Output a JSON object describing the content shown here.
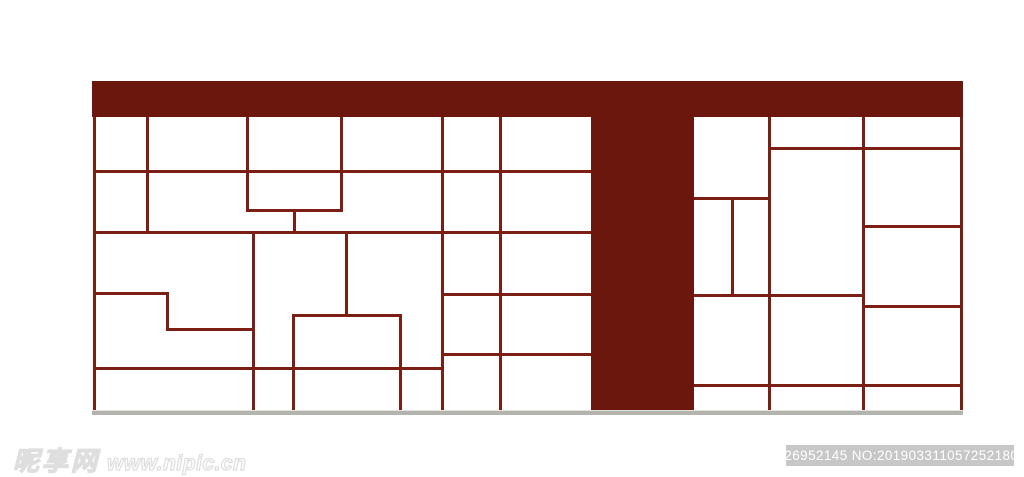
{
  "page": {
    "background": "#ffffff"
  },
  "artwork": {
    "description": "maroon T-shaped lattice partition screen drawing",
    "bar_color": "#6b170e",
    "line_color": "#7b1e13",
    "ground_color": "#b4b4af",
    "ground_highlight": "#e3e3dd",
    "line_thickness": 3,
    "beams": [
      {
        "name": "top-beam",
        "x": 92,
        "y": 81,
        "w": 871,
        "h": 36
      },
      {
        "name": "center-post",
        "x": 591,
        "y": 117,
        "w": 103,
        "h": 294
      }
    ],
    "lines": [
      {
        "x": 93,
        "y": 117,
        "len": 294,
        "dir": "v"
      },
      {
        "x": 146,
        "y": 117,
        "len": 115,
        "dir": "v"
      },
      {
        "x": 246,
        "y": 117,
        "len": 95,
        "dir": "v"
      },
      {
        "x": 340,
        "y": 117,
        "len": 95,
        "dir": "v"
      },
      {
        "x": 293,
        "y": 209,
        "len": 24,
        "dir": "v"
      },
      {
        "x": 441,
        "y": 117,
        "len": 294,
        "dir": "v"
      },
      {
        "x": 499,
        "y": 117,
        "len": 294,
        "dir": "v"
      },
      {
        "x": 252,
        "y": 231,
        "len": 180,
        "dir": "v"
      },
      {
        "x": 345,
        "y": 231,
        "len": 85,
        "dir": "v"
      },
      {
        "x": 292,
        "y": 314,
        "len": 97,
        "dir": "v"
      },
      {
        "x": 399,
        "y": 314,
        "len": 97,
        "dir": "v"
      },
      {
        "x": 166,
        "y": 292,
        "len": 39,
        "dir": "v"
      },
      {
        "x": 93,
        "y": 170,
        "len": 498,
        "dir": "h"
      },
      {
        "x": 246,
        "y": 209,
        "len": 97,
        "dir": "h"
      },
      {
        "x": 93,
        "y": 231,
        "len": 498,
        "dir": "h"
      },
      {
        "x": 93,
        "y": 292,
        "len": 76,
        "dir": "h"
      },
      {
        "x": 166,
        "y": 328,
        "len": 89,
        "dir": "h"
      },
      {
        "x": 292,
        "y": 314,
        "len": 110,
        "dir": "h"
      },
      {
        "x": 441,
        "y": 293,
        "len": 150,
        "dir": "h"
      },
      {
        "x": 441,
        "y": 353,
        "len": 150,
        "dir": "h"
      },
      {
        "x": 93,
        "y": 367,
        "len": 351,
        "dir": "h"
      },
      {
        "x": 768,
        "y": 117,
        "len": 294,
        "dir": "v"
      },
      {
        "x": 862,
        "y": 117,
        "len": 294,
        "dir": "v"
      },
      {
        "x": 960,
        "y": 117,
        "len": 294,
        "dir": "v"
      },
      {
        "x": 731,
        "y": 197,
        "len": 100,
        "dir": "v"
      },
      {
        "x": 768,
        "y": 147,
        "len": 195,
        "dir": "h"
      },
      {
        "x": 694,
        "y": 197,
        "len": 77,
        "dir": "h"
      },
      {
        "x": 862,
        "y": 225,
        "len": 101,
        "dir": "h"
      },
      {
        "x": 694,
        "y": 294,
        "len": 171,
        "dir": "h"
      },
      {
        "x": 862,
        "y": 305,
        "len": 101,
        "dir": "h"
      },
      {
        "x": 694,
        "y": 384,
        "len": 269,
        "dir": "h"
      }
    ],
    "ground": {
      "x": 92,
      "y": 410,
      "w": 871,
      "h": 4
    }
  },
  "watermark": {
    "logo_text": "昵享网",
    "site_text": "www.nipic.cn"
  },
  "badge": {
    "text": "ID:26952145 NO:20190331105725218083",
    "bg": "#c7c7c7",
    "color": "#ffffff"
  }
}
